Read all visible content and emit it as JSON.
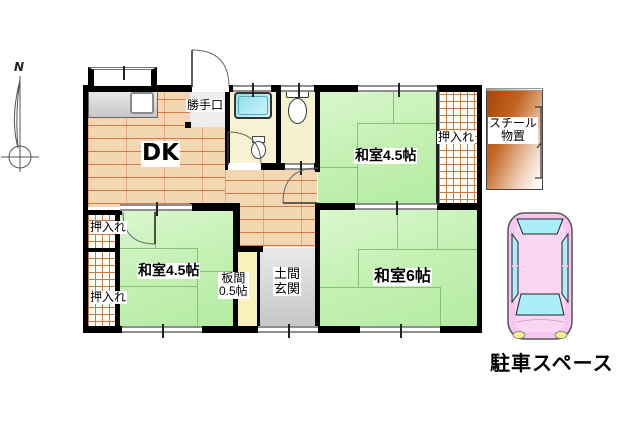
{
  "floor_plan": {
    "compass_label": "N",
    "rooms": {
      "dk": {
        "label": "DK"
      },
      "back_door": {
        "label": "勝手口"
      },
      "washitsu_ne": {
        "label": "和室4.5帖"
      },
      "closet_ne": {
        "label": "押入れ"
      },
      "washitsu_sw": {
        "label": "和室4.5帖"
      },
      "closet_w_upper": {
        "label": "押入れ"
      },
      "closet_w_lower": {
        "label": "押入れ"
      },
      "itanoma": {
        "label_line1": "板間",
        "label_line2": "0.5帖"
      },
      "doma_genkan": {
        "label_line1": "土間",
        "label_line2": "玄関"
      },
      "washitsu_se": {
        "label": "和室6帖"
      }
    },
    "outdoor": {
      "steel_shed": {
        "label_line1": "スチール",
        "label_line2": "物置"
      },
      "parking": {
        "label": "駐車スペース"
      }
    },
    "colors": {
      "tatami_green": "#c6f1b6",
      "tatami_line": "#85c178",
      "wood_floor": "#f3d6b2",
      "wood_line": "#d9784a",
      "closet_hatch_line": "#cc7a44",
      "bath_floor": "#f7f2d2",
      "tub_cyan": "#8edeeb",
      "genkan_gray": "#d9d9d9",
      "itanoma_yellow": "#faf0ba",
      "shed_orange": "#b0520e",
      "car_pink": "#f6c6ee",
      "car_window_cyan": "#a9eef8",
      "wall_black": "#000000"
    }
  }
}
